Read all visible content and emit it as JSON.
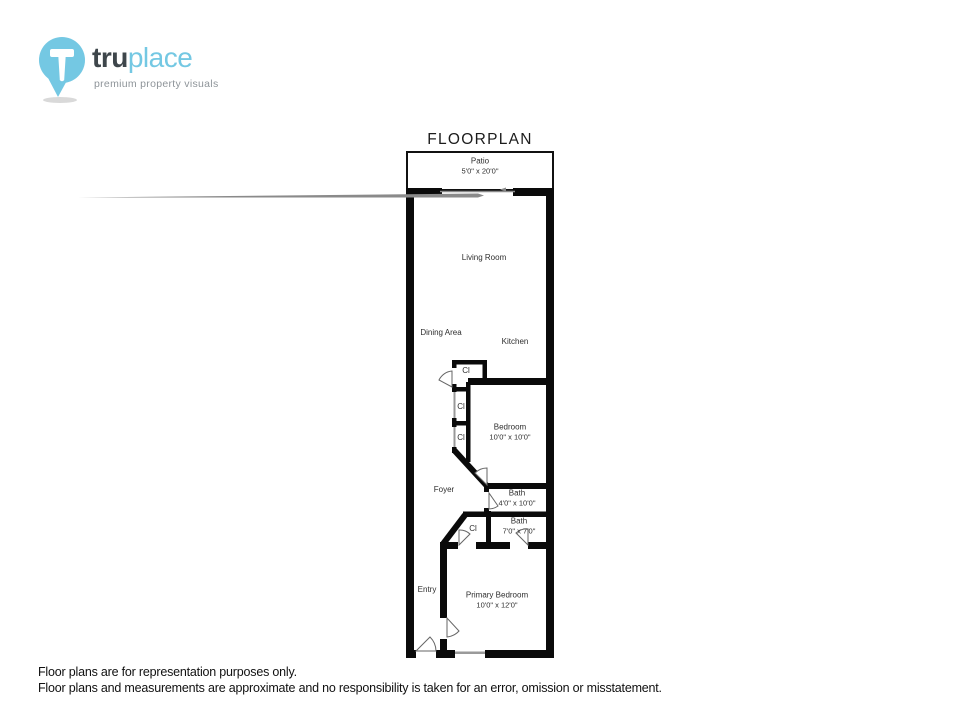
{
  "logo": {
    "brand_bold": "tru",
    "brand_light": "place",
    "tagline": "premium property visuals"
  },
  "title": "FLOORPLAN",
  "colors": {
    "accent": "#74c8e3",
    "wall": "#0a0a0a",
    "door_stroke": "#666666",
    "window_gray": "#9a9a9a"
  },
  "floorplan": {
    "rooms": [
      {
        "id": "patio",
        "name": "Patio",
        "dims": "5'0\" x 20'0\""
      },
      {
        "id": "living",
        "name": "Living Room",
        "dims": ""
      },
      {
        "id": "dining",
        "name": "Dining Area",
        "dims": ""
      },
      {
        "id": "kitchen",
        "name": "Kitchen",
        "dims": ""
      },
      {
        "id": "closet1",
        "name": "Cl",
        "dims": ""
      },
      {
        "id": "closet2",
        "name": "Cl",
        "dims": ""
      },
      {
        "id": "closet3",
        "name": "Cl",
        "dims": ""
      },
      {
        "id": "bedroom",
        "name": "Bedroom",
        "dims": "10'0\" x 10'0\""
      },
      {
        "id": "foyer",
        "name": "Foyer",
        "dims": ""
      },
      {
        "id": "bath1",
        "name": "Bath",
        "dims": "4'0\" x 10'0\""
      },
      {
        "id": "closet4",
        "name": "Cl",
        "dims": ""
      },
      {
        "id": "bath2",
        "name": "Bath",
        "dims": "7'0\" x 7'0\""
      },
      {
        "id": "entry",
        "name": "Entry",
        "dims": ""
      },
      {
        "id": "primary",
        "name": "Primary Bedroom",
        "dims": "10'0\" x 12'0\""
      }
    ]
  },
  "disclaimer": {
    "line1": "Floor plans are for representation purposes only.",
    "line2": "Floor plans and measurements are approximate and no responsibility is taken for an error, omission or misstatement."
  }
}
